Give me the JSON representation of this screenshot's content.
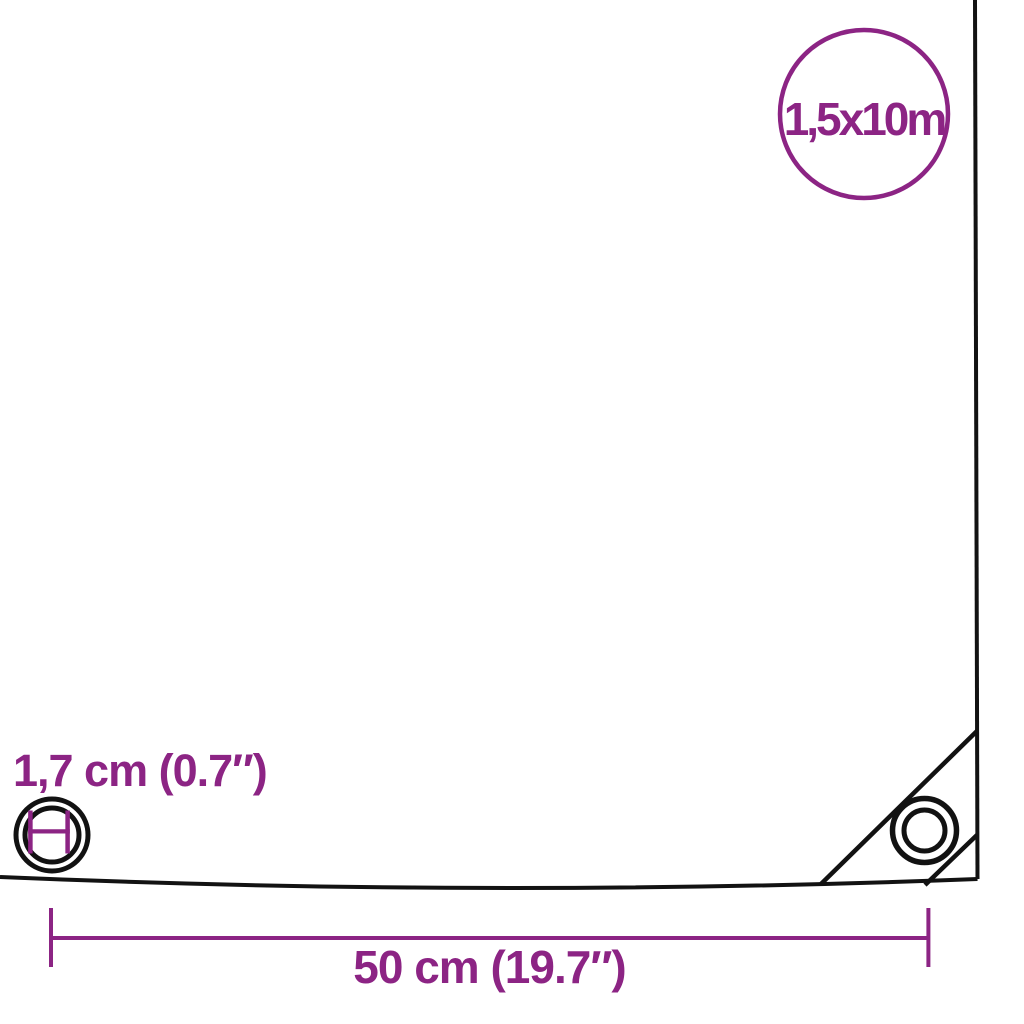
{
  "diagram": {
    "size_badge": {
      "label": "1,5x10m"
    },
    "eyelet_dimension": {
      "label": "1,7 cm (0.7″)"
    },
    "width_dimension": {
      "label": "50 cm (19.7″)"
    }
  },
  "icons": {
    "size_badge": "circle-badge-icon",
    "left_eyelet": "eyelet-rings-icon",
    "diameter_marker": "diameter-h-marker-icon",
    "corner_eyelet": "corner-eyelet-icon",
    "corner_fold": "corner-fold-lines",
    "dimension": "dimension-line-with-end-ticks"
  },
  "colors": {
    "accent_purple": "#8c2484",
    "outline_black": "#121212",
    "background": "#ffffff"
  }
}
